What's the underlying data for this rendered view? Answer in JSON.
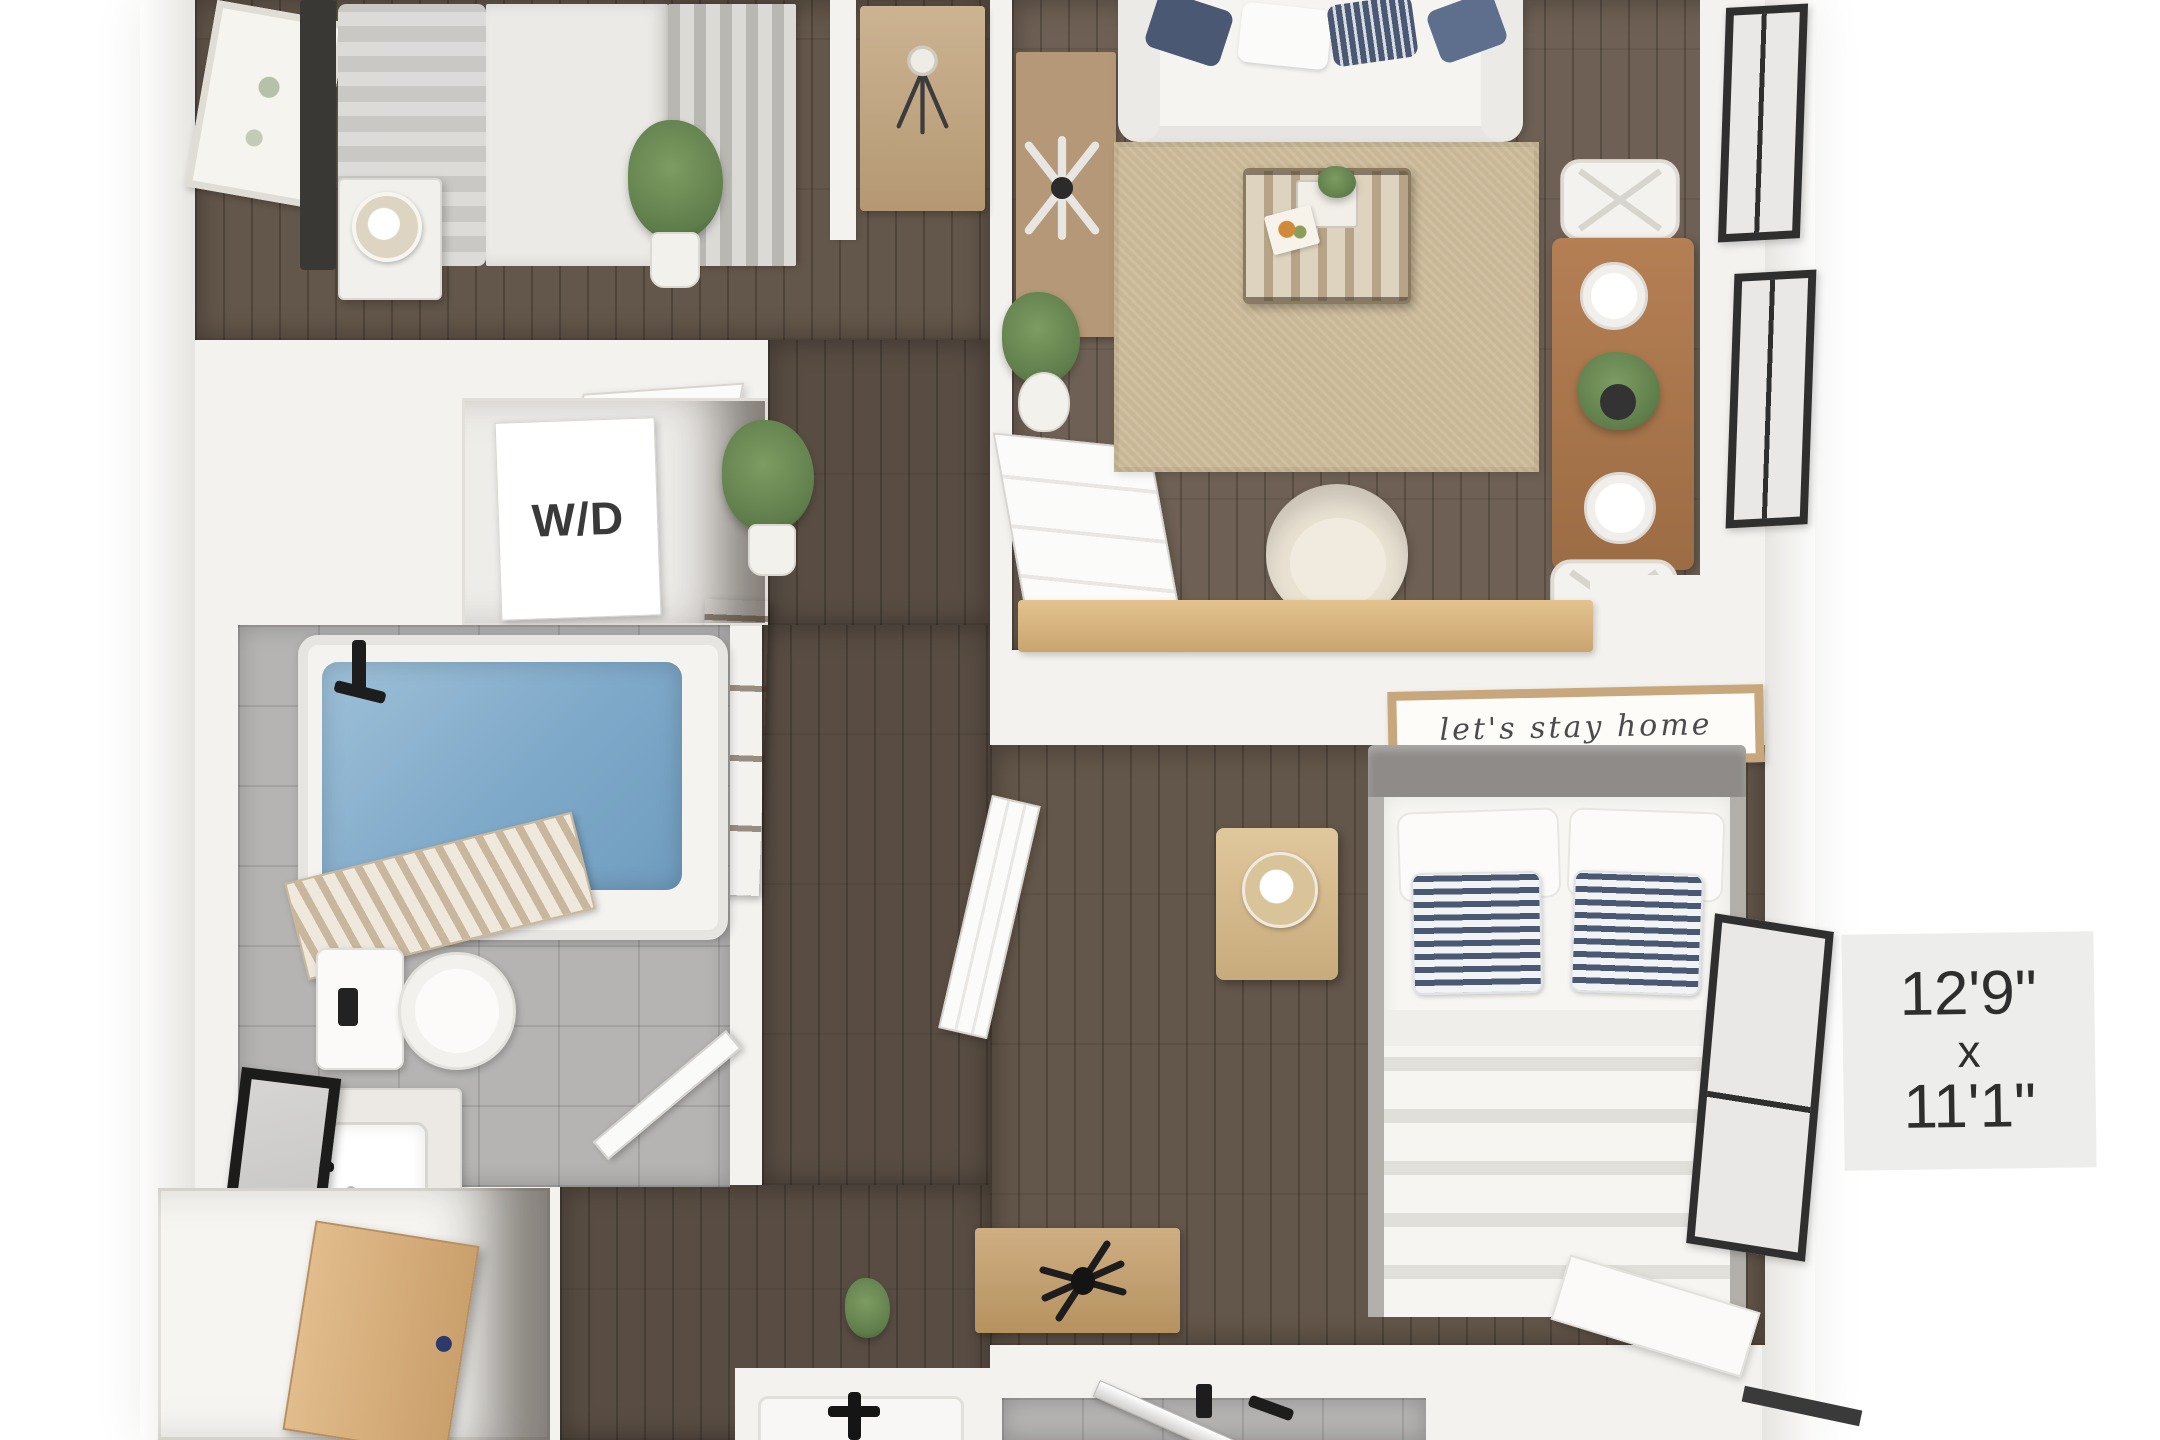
{
  "floorplan": {
    "wd_label": "W/D",
    "sign_text": "let's stay home",
    "dimension_label": {
      "line1": "12'9\"",
      "line2": "x",
      "line3": "11'1\""
    }
  },
  "palette": {
    "background": "#ffffff",
    "wall": "#f4f2ef",
    "wall_shade": "#e5e2de",
    "wood_floor": "#63564a",
    "wood_floor_living": "#6e6054",
    "wood_floor_dark": "#594d43",
    "rug": "#c8b694",
    "tile": "#b5b4b2",
    "tub_water": "#7fa9c9",
    "light_wood": "#d9b486",
    "mid_wood": "#aa784f",
    "navy_pillow": "#4a5874",
    "window_frame": "#2f2f2f",
    "black_fixture": "#1d1d1d",
    "plant_green": "#5e7d4a",
    "label_bg": "#ededeb",
    "label_text": "#2e2e2e"
  }
}
